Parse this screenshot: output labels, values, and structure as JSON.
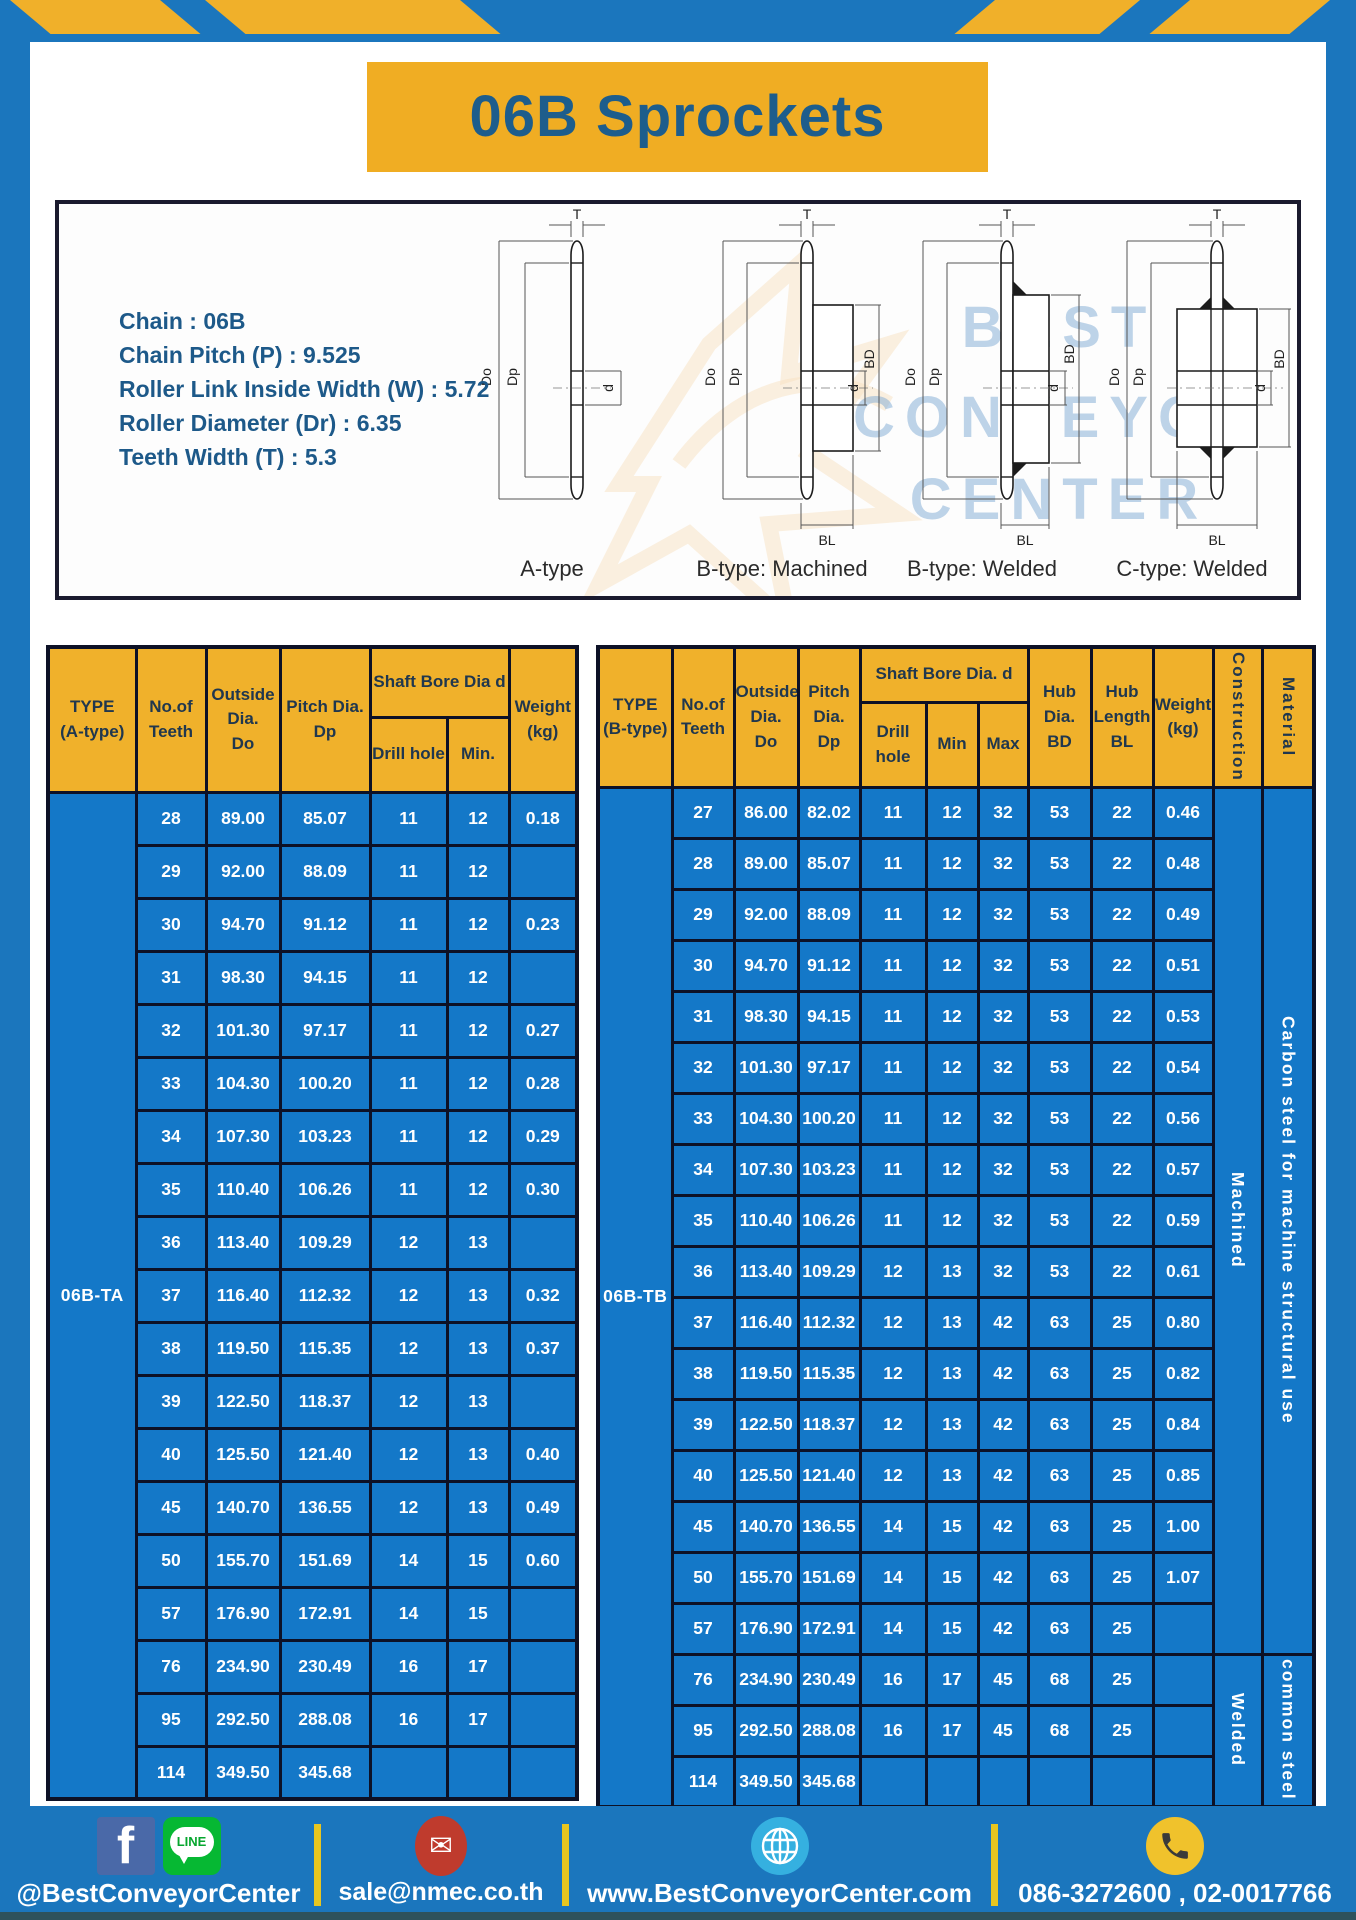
{
  "page": {
    "title": "06B Sprockets"
  },
  "specs": {
    "lines": [
      "Chain  : 06B",
      "Chain Pitch (P)  :  9.525",
      "Roller Link Inside Width (W)  :  5.72",
      "Roller Diameter (Dr)  : 6.35",
      "Teeth Width (T)  :  5.3"
    ]
  },
  "watermark": {
    "line1": "BEST",
    "line2": "CONVEYOR",
    "line3": "CENTER"
  },
  "diagrams": [
    {
      "label": "A-type",
      "t": "T",
      "do": "Do",
      "dp": "Dp",
      "d": "d"
    },
    {
      "label": "B-type: Machined",
      "t": "T",
      "do": "Do",
      "dp": "Dp",
      "d": "d",
      "bd": "BD",
      "bl": "BL"
    },
    {
      "label": "B-type: Welded",
      "t": "T",
      "do": "Do",
      "dp": "Dp",
      "d": "d",
      "bd": "BD",
      "bl": "BL"
    },
    {
      "label": "C-type: Welded",
      "t": "T",
      "do": "Do",
      "dp": "Dp",
      "d": "d",
      "bd": "BD",
      "bl": "BL"
    }
  ],
  "table_a": {
    "headers": {
      "type": "TYPE\n(A-type)",
      "teeth": "No.of\nTeeth",
      "outside": "Outside\nDia.\nDo",
      "pitch": "Pitch Dia.\nDp",
      "shaft": "Shaft Bore Dia d",
      "drill": "Drill hole",
      "min": "Min.",
      "weight": "Weight\n(kg)"
    },
    "type_label": "06B-TA",
    "rows": [
      [
        "28",
        "89.00",
        "85.07",
        "11",
        "12",
        "0.18"
      ],
      [
        "29",
        "92.00",
        "88.09",
        "11",
        "12",
        ""
      ],
      [
        "30",
        "94.70",
        "91.12",
        "11",
        "12",
        "0.23"
      ],
      [
        "31",
        "98.30",
        "94.15",
        "11",
        "12",
        ""
      ],
      [
        "32",
        "101.30",
        "97.17",
        "11",
        "12",
        "0.27"
      ],
      [
        "33",
        "104.30",
        "100.20",
        "11",
        "12",
        "0.28"
      ],
      [
        "34",
        "107.30",
        "103.23",
        "11",
        "12",
        "0.29"
      ],
      [
        "35",
        "110.40",
        "106.26",
        "11",
        "12",
        "0.30"
      ],
      [
        "36",
        "113.40",
        "109.29",
        "12",
        "13",
        ""
      ],
      [
        "37",
        "116.40",
        "112.32",
        "12",
        "13",
        "0.32"
      ],
      [
        "38",
        "119.50",
        "115.35",
        "12",
        "13",
        "0.37"
      ],
      [
        "39",
        "122.50",
        "118.37",
        "12",
        "13",
        ""
      ],
      [
        "40",
        "125.50",
        "121.40",
        "12",
        "13",
        "0.40"
      ],
      [
        "45",
        "140.70",
        "136.55",
        "12",
        "13",
        "0.49"
      ],
      [
        "50",
        "155.70",
        "151.69",
        "14",
        "15",
        "0.60"
      ],
      [
        "57",
        "176.90",
        "172.91",
        "14",
        "15",
        ""
      ],
      [
        "76",
        "234.90",
        "230.49",
        "16",
        "17",
        ""
      ],
      [
        "95",
        "292.50",
        "288.08",
        "16",
        "17",
        ""
      ],
      [
        "114",
        "349.50",
        "345.68",
        "",
        "",
        ""
      ]
    ]
  },
  "table_b": {
    "headers": {
      "type": "TYPE\n(B-type)",
      "teeth": "No.of\nTeeth",
      "outside": "Outside\nDia.\nDo",
      "pitch": "Pitch\nDia.\nDp",
      "shaft": "Shaft Bore Dia. d",
      "drill": "Drill hole",
      "min": "Min",
      "max": "Max",
      "hub_dia": "Hub\nDia.\nBD",
      "hub_len": "Hub\nLength\nBL",
      "weight": "Weight\n(kg)",
      "construction": "Construction",
      "material": "Material"
    },
    "type_label": "06B-TB",
    "rows": [
      [
        "27",
        "86.00",
        "82.02",
        "11",
        "12",
        "32",
        "53",
        "22",
        "0.46"
      ],
      [
        "28",
        "89.00",
        "85.07",
        "11",
        "12",
        "32",
        "53",
        "22",
        "0.48"
      ],
      [
        "29",
        "92.00",
        "88.09",
        "11",
        "12",
        "32",
        "53",
        "22",
        "0.49"
      ],
      [
        "30",
        "94.70",
        "91.12",
        "11",
        "12",
        "32",
        "53",
        "22",
        "0.51"
      ],
      [
        "31",
        "98.30",
        "94.15",
        "11",
        "12",
        "32",
        "53",
        "22",
        "0.53"
      ],
      [
        "32",
        "101.30",
        "97.17",
        "11",
        "12",
        "32",
        "53",
        "22",
        "0.54"
      ],
      [
        "33",
        "104.30",
        "100.20",
        "11",
        "12",
        "32",
        "53",
        "22",
        "0.56"
      ],
      [
        "34",
        "107.30",
        "103.23",
        "11",
        "12",
        "32",
        "53",
        "22",
        "0.57"
      ],
      [
        "35",
        "110.40",
        "106.26",
        "11",
        "12",
        "32",
        "53",
        "22",
        "0.59"
      ],
      [
        "36",
        "113.40",
        "109.29",
        "12",
        "13",
        "32",
        "53",
        "22",
        "0.61"
      ],
      [
        "37",
        "116.40",
        "112.32",
        "12",
        "13",
        "42",
        "63",
        "25",
        "0.80"
      ],
      [
        "38",
        "119.50",
        "115.35",
        "12",
        "13",
        "42",
        "63",
        "25",
        "0.82"
      ],
      [
        "39",
        "122.50",
        "118.37",
        "12",
        "13",
        "42",
        "63",
        "25",
        "0.84"
      ],
      [
        "40",
        "125.50",
        "121.40",
        "12",
        "13",
        "42",
        "63",
        "25",
        "0.85"
      ],
      [
        "45",
        "140.70",
        "136.55",
        "14",
        "15",
        "42",
        "63",
        "25",
        "1.00"
      ],
      [
        "50",
        "155.70",
        "151.69",
        "14",
        "15",
        "42",
        "63",
        "25",
        "1.07"
      ],
      [
        "57",
        "176.90",
        "172.91",
        "14",
        "15",
        "42",
        "63",
        "25",
        ""
      ],
      [
        "76",
        "234.90",
        "230.49",
        "16",
        "17",
        "45",
        "68",
        "25",
        ""
      ],
      [
        "95",
        "292.50",
        "288.08",
        "16",
        "17",
        "45",
        "68",
        "25",
        ""
      ],
      [
        "114",
        "349.50",
        "345.68",
        "",
        "",
        "",
        "",
        "",
        ""
      ]
    ],
    "construction": [
      {
        "label": "Machined",
        "span": 17
      },
      {
        "label": "Welded",
        "span": 3
      }
    ],
    "material": [
      {
        "label": "Carbon steel for machine structural use",
        "span": 17
      },
      {
        "label": "common steel",
        "span": 3
      }
    ]
  },
  "footer": {
    "line_badge": "LINE",
    "fb_letter": "f",
    "mail_glyph": "✉",
    "sections": [
      {
        "icons": [
          "facebook-icon",
          "line-icon"
        ],
        "text": "@BestConveyorCenter"
      },
      {
        "icons": [
          "mail-icon"
        ],
        "text": "sale@nmec.co.th"
      },
      {
        "icons": [
          "globe-icon"
        ],
        "text": "www.BestConveyorCenter.com"
      },
      {
        "icons": [
          "phone-icon"
        ],
        "text": "086-3272600 , 02-0017766"
      }
    ]
  }
}
